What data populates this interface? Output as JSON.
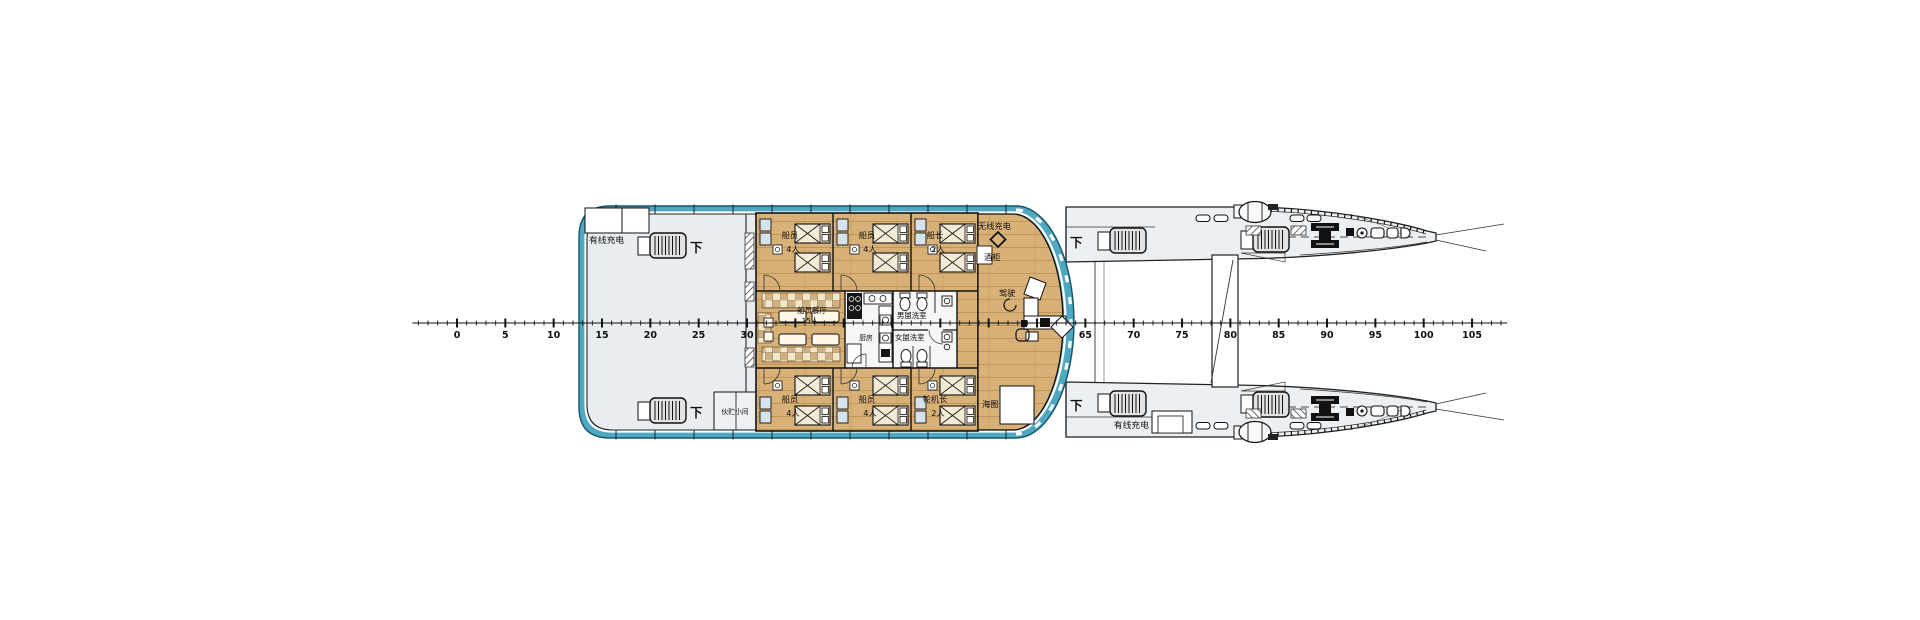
{
  "ruler": {
    "y": 323,
    "x_zero": 457,
    "px_per_unit": 9.667,
    "tick_from": -4,
    "tick_to": 108,
    "major_step": 5,
    "labels": [
      0,
      5,
      10,
      15,
      20,
      25,
      30,
      65,
      70,
      75,
      80,
      85,
      90,
      95,
      100,
      105
    ]
  },
  "labels": {
    "down": "下",
    "wired_charging": "有线充电",
    "wireless_charging": "无线充电",
    "wine_cabinet": "酒柜",
    "helm": "驾驶",
    "chart_table": "海图",
    "galley": "厨房",
    "mess_room_line1": "船员餐厅",
    "mess_room_line2": "15人",
    "washroom_men": "男盥洗室",
    "washroom_women": "女盥洗室",
    "store_room": "伙贮小间"
  },
  "cabins": [
    {
      "name": "crew-cabin-top-1",
      "line1": "船员",
      "line2": "4人"
    },
    {
      "name": "crew-cabin-top-2",
      "line1": "船员",
      "line2": "4人"
    },
    {
      "name": "captain-cabin",
      "line1": "船长",
      "line2": "2人"
    },
    {
      "name": "crew-cabin-bottom-1",
      "line1": "船员",
      "line2": "4人"
    },
    {
      "name": "crew-cabin-bottom-2",
      "line1": "船员",
      "line2": "4人"
    },
    {
      "name": "chief-engineer-cabin",
      "line1": "轮机长",
      "line2": "2人"
    }
  ],
  "colors": {
    "superstructure_band": "#4fa8c0",
    "superstructure_edge": "#14556b",
    "floor": "#e9edf2",
    "wood": "#d8b179",
    "wood_line": "#c19555",
    "hull_fill": "#edf0f2",
    "ink": "#111111"
  }
}
